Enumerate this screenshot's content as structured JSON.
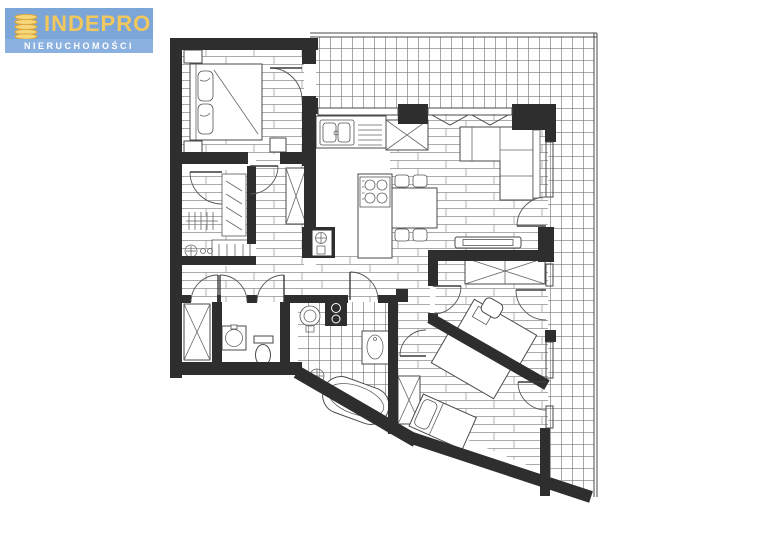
{
  "logo": {
    "brand": "INDEPRO",
    "subtitle": "NIERUCHOMOŚCI",
    "colors": {
      "background": "#7BA6D7",
      "band": "#8AB1DF",
      "brand_text": "#F2C85E",
      "subtitle_text": "#FFFFFF",
      "icon_fill": "#F5D678",
      "icon_stroke": "#D9A33C"
    }
  },
  "floor_plan": {
    "type": "apartment-architectural-plan",
    "labels_visible": "none",
    "colors": {
      "paper": "#FFFFFF",
      "walls": "#2E2E2E",
      "lines": "#4A4A4A",
      "plank_hatch": "#8F8F8F",
      "tile_hatch": "#787878"
    },
    "areas": [
      {
        "name": "bedroom-1",
        "floor": "wood-planks"
      },
      {
        "name": "walk-in-wardrobe",
        "floor": "wood-planks"
      },
      {
        "name": "corridor",
        "floor": "wood-planks"
      },
      {
        "name": "hallway",
        "floor": "wood-planks"
      },
      {
        "name": "kitchen",
        "floor": "plain"
      },
      {
        "name": "dining-living-room",
        "floor": "wood-planks"
      },
      {
        "name": "storage-closet",
        "floor": "plain"
      },
      {
        "name": "wc",
        "floor": "plain"
      },
      {
        "name": "bathroom",
        "floor": "ceramic-tiles"
      },
      {
        "name": "bedroom-2",
        "floor": "wood-planks"
      },
      {
        "name": "bedroom-3",
        "floor": "wood-planks"
      },
      {
        "name": "terrace",
        "floor": "ceramic-tiles"
      }
    ],
    "fixtures": [
      "double-bed",
      "nightstands",
      "wardrobe-rails",
      "washing-machine",
      "tall-cabinet",
      "kitchen-sink",
      "gas-hob",
      "fridge",
      "kitchen-island",
      "dining-table",
      "chairs",
      "corner-sofa",
      "tv-cabinet",
      "pedestal-washbasin",
      "stacked-washer-dryer",
      "vanity-washbasin",
      "freestanding-bathtub",
      "toilet",
      "floor-drain",
      "desks",
      "desk-chair",
      "single-bed",
      "door-swings",
      "utility-shaft"
    ]
  }
}
